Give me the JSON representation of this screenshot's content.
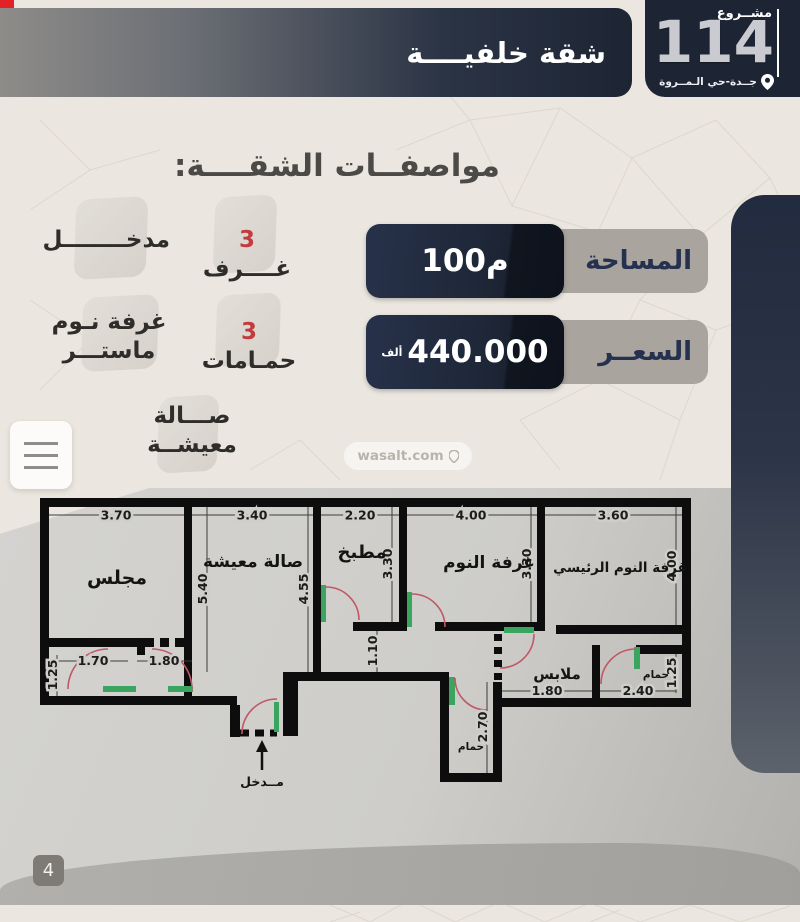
{
  "header": {
    "title": "شقة خلفيــــة"
  },
  "project": {
    "label": "مشــروع",
    "number": "114",
    "location": "جــدة-حي الـمــروة"
  },
  "specs": {
    "heading": "مواصفــات الشقــــة:",
    "rooms_count": "3",
    "rooms_label": "غــــرف",
    "entrance": "مدخــــــــل",
    "master_line1": "غرفة نـوم",
    "master_line2": "ماستـــر",
    "baths_count": "3",
    "baths_label": "حمـامات",
    "living_line1": "صـــالة",
    "living_line2": "معيشــة"
  },
  "info": {
    "area_label": "المساحة",
    "area_value": "100م",
    "price_label": "السعــر",
    "price_value": "440.000",
    "price_unit": "ألف"
  },
  "floor_plan": {
    "rooms": {
      "majlis": "مجلس",
      "living": "صالة معيشة",
      "kitchen": "مطبخ",
      "bedroom": "غرفة النوم",
      "master_bedroom": "غرفة النوم الرئيسي",
      "closet": "ملابس",
      "bathroom_right": "حمام",
      "bathroom_bottom": "حمام",
      "entrance": "مــدخل"
    },
    "dimensions": {
      "majlis_width": "3.70",
      "living_width": "3.40",
      "kitchen_width": "2.20",
      "bedroom_width": "4.00",
      "master_width": "3.60",
      "living_height_left": "5.40",
      "living_height_right": "4.55",
      "kitchen_height": "3.30",
      "bedroom_height": "3.30",
      "master_height": "4.00",
      "hall_width": "1.10",
      "corridor_door_1": "1.70",
      "corridor_door_2": "1.80",
      "corridor_height": "1.25",
      "closet_width": "1.80",
      "bathroom_right_width": "2.40",
      "bathroom_right_height": "1.25",
      "bathroom_bottom_height": "2.70"
    }
  },
  "watermark": {
    "text": "wasalt.com"
  },
  "page": {
    "number": "4"
  },
  "colors": {
    "navy": "#1e2736",
    "bar_gray": "#a9a49d",
    "accent_red": "#c43b3d",
    "door_green": "#3aa55e",
    "door_arc": "#c05866"
  }
}
